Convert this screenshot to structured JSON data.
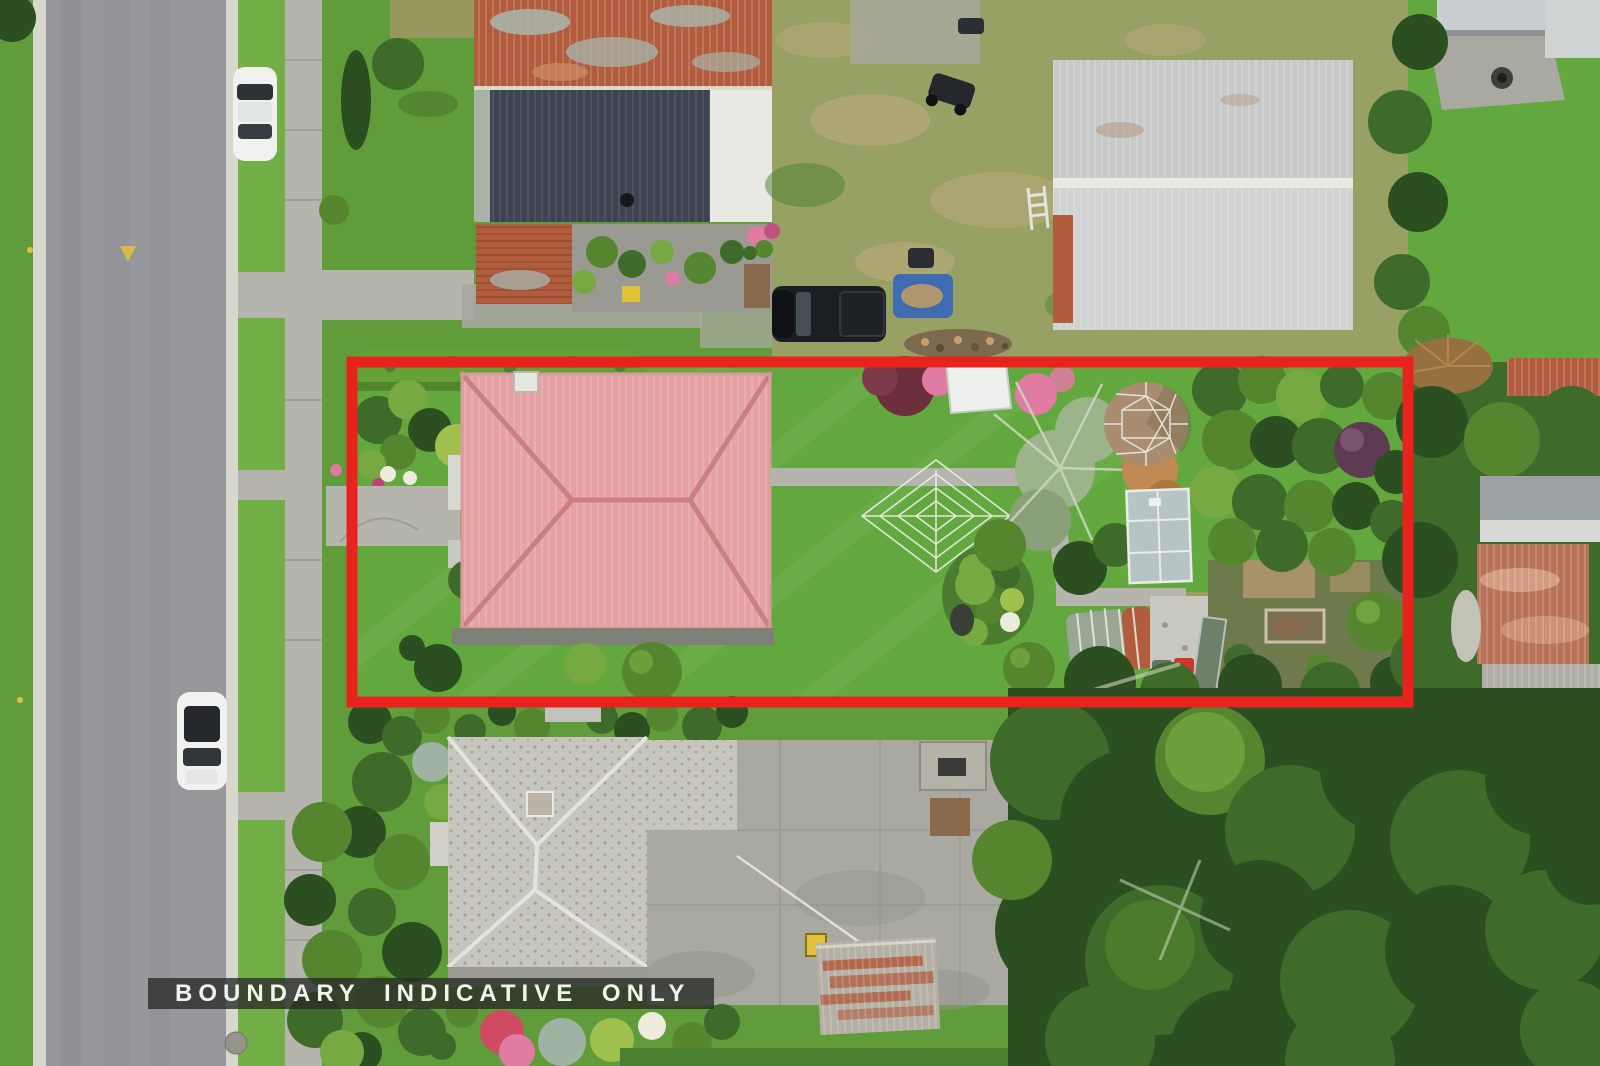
{
  "meta": {
    "description": "Aerial drone photograph of a residential section outlined with a red indicative boundary",
    "image_width": 1600,
    "image_height": 1066
  },
  "overlay": {
    "banner_text": "BOUNDARY INDICATIVE ONLY"
  },
  "boundary": {
    "color": "#e8231e",
    "stroke_px": 11
  },
  "palette": {
    "boundary": "#e8231e",
    "banner-bg": "rgba(40,42,38,0.78)",
    "banner-text": "#f2f2ee",
    "road": "#97989b",
    "road-dark": "#898b8e",
    "curb": "#d7d7cd",
    "path": "#b5b5ad",
    "joint": "#94948c",
    "concrete": "#a9a9a1",
    "grass": "#609c3a",
    "grass-light": "#72b047",
    "grass-dark": "#4b8030",
    "lawn": "#62a83e",
    "olive": "#97a163",
    "dry": "#b4a878",
    "rust": "#b05c3d",
    "rust-light": "#d08d67",
    "patina": "#a9b2a6",
    "roof-dark": "#3d4350",
    "roof-white": "#e9e9e3",
    "shed": "#c7cac9",
    "shed-dark": "#aab0b1",
    "roof-red": "#e6a2a2",
    "roof-red-ridge": "#cb7f83",
    "roof-speckled": "#c6c6c0",
    "tree-dark": "#2c4f21",
    "tree-mid": "#3f6b2a",
    "tree-green": "#55862f",
    "tree-light": "#77a942",
    "tree-yellow": "#9fc04d",
    "tree-silver": "#9cb489",
    "flower-pink": "#e07ba3",
    "flower-red": "#cf4a62",
    "flower-white": "#ecebdc",
    "maple": "#5d3b52",
    "dome": "#aa8d6e",
    "glass": "#b7c4c6",
    "tarp": "#3f6cb0",
    "car": "#f1f2f0",
    "vehicle": "#1b1e22",
    "yellow": "#e2c23a",
    "bin-red": "#cd372e",
    "gravel": "#c9c9c1",
    "dirt": "#b1976e",
    "wood": "#8a6a4c"
  },
  "scene": {
    "objects": [
      "street",
      "footpath",
      "grass-berm",
      "parked-car",
      "second-parked-car",
      "neighbour-house-rusty-roof",
      "neighbour-house-dark-roof",
      "large-corrugated-shed",
      "black-pickup-truck",
      "blue-tarp",
      "ride-on-mower",
      "ladder",
      "subject-house-red-hip-roof",
      "trimmed-hedge",
      "front-garden-bed",
      "rotary-clothesline",
      "geodesic-dome",
      "glasshouse",
      "barrel-greenhouse",
      "garden-island-bed",
      "vegetable-garden",
      "red-wheelie-bin",
      "gravel-pad",
      "bottom-neighbour-house",
      "concrete-driveway",
      "rusty-garden-shed",
      "yellow-birdhouse",
      "clothesline-wire",
      "forest-trees",
      "lawns",
      "flower-borders",
      "red-boundary-outline",
      "boundary-banner"
    ]
  }
}
